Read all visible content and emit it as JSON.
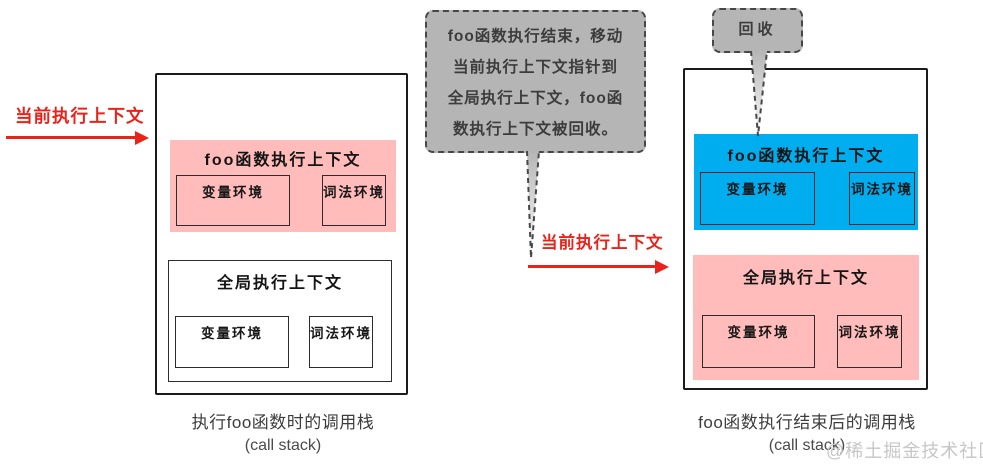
{
  "colors": {
    "pink": "#ffbcba",
    "blue": "#00aeef",
    "bubble_gray": "#b5b5b5",
    "red": "#e9231a",
    "watermark_gray": "#c6c6c6"
  },
  "left_pointer": {
    "label": "当前执行上下文"
  },
  "middle_pointer": {
    "label": "当前执行上下文"
  },
  "note_bubble": {
    "lines": [
      "foo函数执行结束，移动",
      "当前执行上下文指针到",
      "全局执行上下文，foo函",
      "数执行上下文被回收。"
    ]
  },
  "recycle_bubble": {
    "label": "回收"
  },
  "left_stack": {
    "foo_context": {
      "title": "foo函数执行上下文",
      "var_env": "变量环境",
      "lex_env": "词法环境"
    },
    "global_context": {
      "title": "全局执行上下文",
      "var_env": "变量环境",
      "lex_env": "词法环境"
    },
    "caption_line1": "执行foo函数时的调用栈",
    "caption_line2": "(call stack)"
  },
  "right_stack": {
    "foo_context": {
      "title": "foo函数执行上下文",
      "var_env": "变量环境",
      "lex_env": "词法环境"
    },
    "global_context": {
      "title": "全局执行上下文",
      "var_env": "变量环境",
      "lex_env": "词法环境"
    },
    "caption_line1": "foo函数执行结束后的调用栈",
    "caption_line2": "(call stack)"
  },
  "watermark": "@稀土掘金技术社区"
}
